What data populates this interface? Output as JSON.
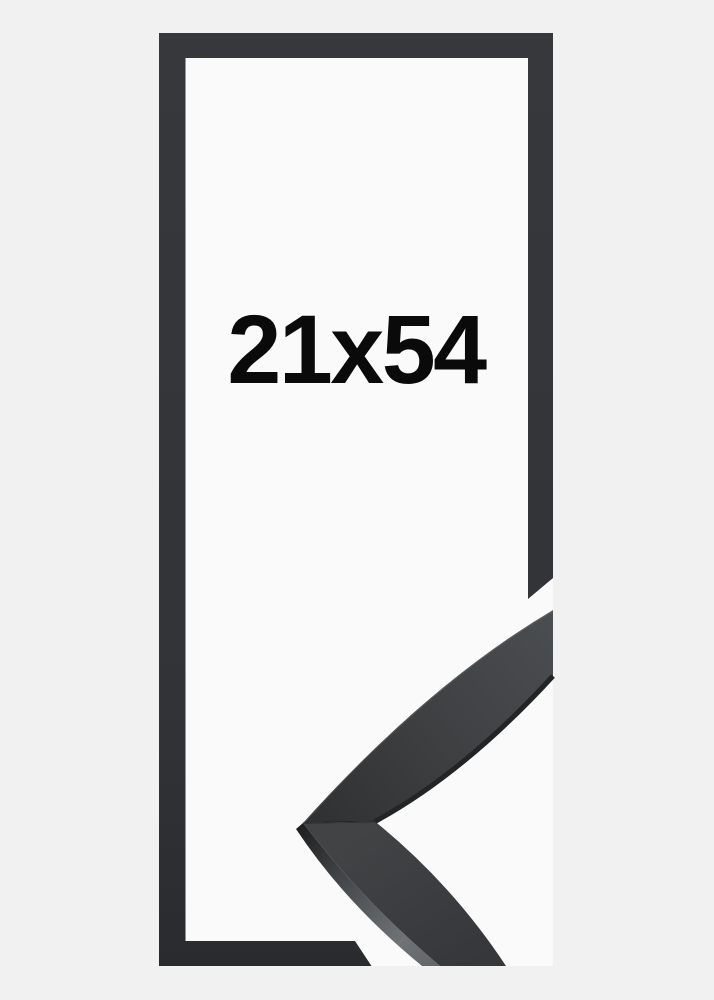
{
  "product_image": {
    "size_label": "21x54"
  },
  "colors": {
    "bg_color": "#f1f1f2",
    "mat_color": "#fafafa",
    "frame_color": "#36383c",
    "frame_color_dark": "#2a2b2e",
    "corner_face_color": "#3e4042",
    "corner_side_highlight": "#707376",
    "label_color": "#0a0a0a"
  }
}
